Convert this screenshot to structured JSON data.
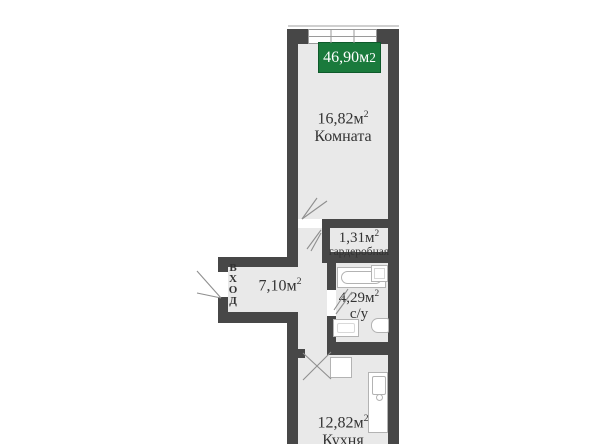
{
  "title_badge": {
    "area": "46,90м",
    "sup": "2"
  },
  "rooms": {
    "living": {
      "area": "16,82м",
      "sup": "2",
      "name": "Комната"
    },
    "wardrobe": {
      "area": "1,31м",
      "sup": "2",
      "name": "гардеробная"
    },
    "hallway": {
      "area": "7,10м",
      "sup": "2"
    },
    "bathroom": {
      "area": "4,29м",
      "sup": "2",
      "name": "с/у"
    },
    "kitchen": {
      "area": "12,82м",
      "sup": "2",
      "name": "Кухня"
    }
  },
  "entrance": {
    "letters": [
      "В",
      "Х",
      "О",
      "Д"
    ]
  },
  "fixtures": [
    "bathtub",
    "washer",
    "bath-sink",
    "toilet",
    "fridge",
    "kitchen-counter",
    "kitchen-sink"
  ],
  "colors": {
    "wall": "#474747",
    "floor": "#e9e9e9",
    "badge_green": "#1a7a3c",
    "badge_border": "#0e5a2b",
    "badge_text": "#ffffff",
    "line": "#9a9a9a",
    "text": "#333333",
    "fixture": "#ffffff",
    "fixture_border": "#b3b3b3",
    "background": "#ffffff"
  }
}
